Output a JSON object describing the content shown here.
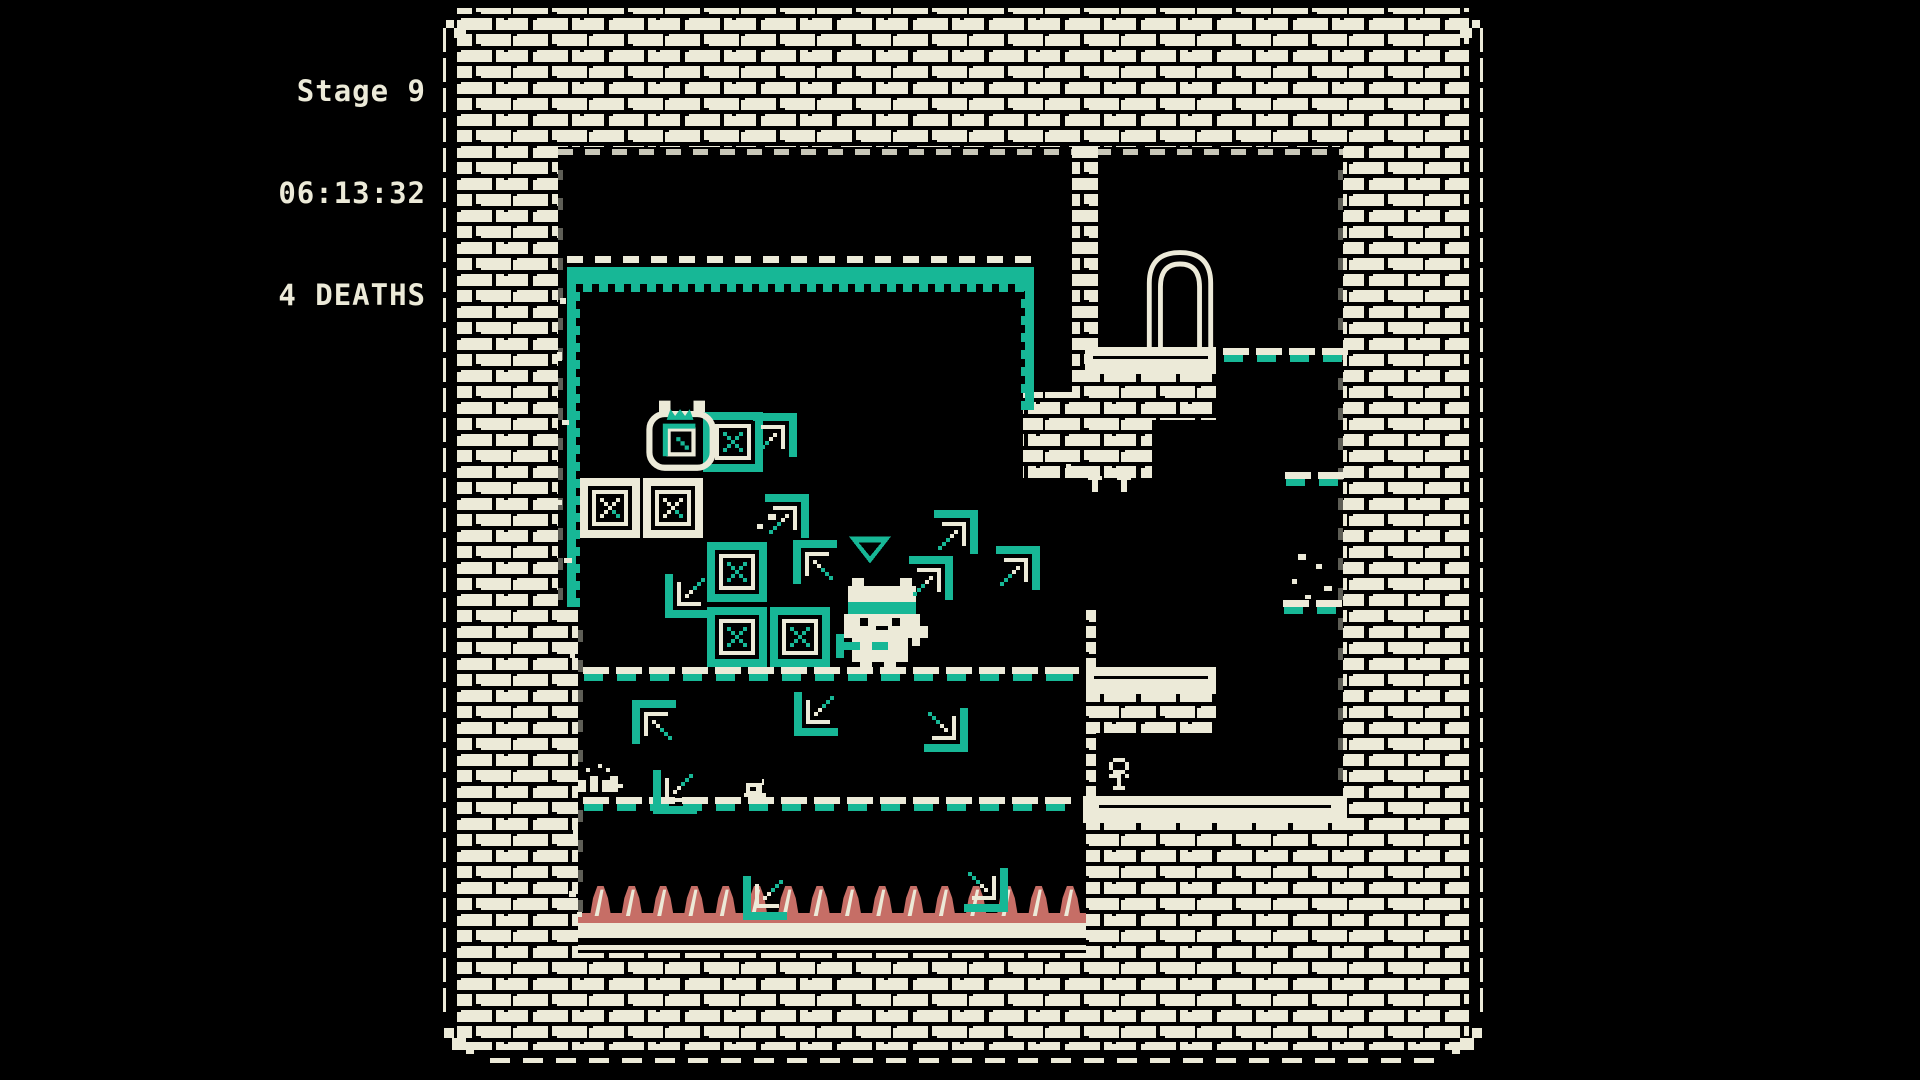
{
  "hud": {
    "stage": "Stage 9",
    "time": "06:13:32",
    "deaths": "4 DEATHS"
  },
  "palette": {
    "cream": "#ECEAD8",
    "teal": "#17B796",
    "rose": "#C66E66",
    "black": "#000000"
  },
  "stage": {
    "frame": {
      "x": 436,
      "y": 0,
      "w": 1054,
      "h": 1080
    },
    "cavities": [
      {
        "x": 558,
        "y": 147,
        "w": 517,
        "h": 460
      },
      {
        "x": 1075,
        "y": 478,
        "w": 21,
        "h": 129
      },
      {
        "x": 578,
        "y": 607,
        "w": 508,
        "h": 346
      },
      {
        "x": 1096,
        "y": 147,
        "w": 247,
        "h": 676
      }
    ],
    "brick_patches": [
      {
        "x": 1072,
        "y": 147,
        "w": 26,
        "h": 247
      },
      {
        "x": 1023,
        "y": 392,
        "w": 129,
        "h": 86
      },
      {
        "x": 1085,
        "y": 373,
        "w": 131,
        "h": 47
      },
      {
        "x": 1090,
        "y": 694,
        "w": 126,
        "h": 39
      }
    ],
    "ledges": [
      {
        "x": 1085,
        "y": 347,
        "w": 131,
        "h": 27
      },
      {
        "x": 1086,
        "y": 667,
        "w": 130,
        "h": 27
      },
      {
        "x": 1083,
        "y": 796,
        "w": 264,
        "h": 27
      }
    ],
    "arch": {
      "x": 1140,
      "y": 243,
      "w": 80,
      "h": 105
    },
    "zone": {
      "top": {
        "x": 567,
        "y": 256,
        "w": 467,
        "h": 36
      },
      "left": {
        "x": 567,
        "y": 272,
        "w": 13,
        "h": 335
      },
      "right": {
        "x": 1021,
        "y": 272,
        "w": 13,
        "h": 138
      }
    },
    "edge_rows": [
      {
        "x": 558,
        "y": 149,
        "w": 517
      },
      {
        "x": 1096,
        "y": 149,
        "w": 247
      }
    ],
    "edge_cols": [
      {
        "x": 558,
        "y": 170,
        "h": 430
      },
      {
        "x": 578,
        "y": 612,
        "h": 300
      },
      {
        "x": 1338,
        "y": 170,
        "h": 640
      }
    ],
    "dash_rows": [
      {
        "x": 583,
        "y": 667,
        "count": 15
      },
      {
        "x": 1053,
        "y": 667,
        "count": 1
      },
      {
        "x": 583,
        "y": 797,
        "count": 15
      },
      {
        "x": 1223,
        "y": 348,
        "count": 4
      },
      {
        "x": 1285,
        "y": 472,
        "count": 2
      },
      {
        "x": 1283,
        "y": 600,
        "count": 2
      }
    ],
    "spikes": {
      "x": 585,
      "y": 886,
      "count": 16,
      "pitch": 31.3
    },
    "pit": {
      "x": 578,
      "y": 913,
      "w": 508,
      "h": 40
    }
  },
  "sprites": [
    {
      "type": "crate-teal",
      "x": 703,
      "y": 412
    },
    {
      "type": "crate-cream",
      "x": 580,
      "y": 478
    },
    {
      "type": "crate-cream",
      "x": 643,
      "y": 478
    },
    {
      "type": "crate-teal",
      "x": 707,
      "y": 542
    },
    {
      "type": "crate-teal",
      "x": 707,
      "y": 607
    },
    {
      "type": "crate-teal",
      "x": 770,
      "y": 607
    },
    {
      "type": "ghost-cat",
      "x": 636,
      "y": 396
    },
    {
      "type": "marker",
      "x": 849,
      "y": 536
    },
    {
      "type": "cat",
      "x": 836,
      "y": 578
    },
    {
      "type": "bracket",
      "x": 749,
      "y": 413,
      "rot": 0
    },
    {
      "type": "bracket",
      "x": 761,
      "y": 494,
      "rot": 0
    },
    {
      "type": "bracket",
      "x": 930,
      "y": 510,
      "rot": 0
    },
    {
      "type": "bracket",
      "x": 905,
      "y": 556,
      "rot": 0
    },
    {
      "type": "bracket",
      "x": 992,
      "y": 546,
      "rot": 0
    },
    {
      "type": "bracket",
      "x": 793,
      "y": 540,
      "rot": 270
    },
    {
      "type": "bracket",
      "x": 665,
      "y": 570,
      "rot": 180
    },
    {
      "type": "bracket",
      "x": 632,
      "y": 700,
      "rot": 270
    },
    {
      "type": "bracket",
      "x": 794,
      "y": 688,
      "rot": 180
    },
    {
      "type": "bracket",
      "x": 920,
      "y": 704,
      "rot": 90
    },
    {
      "type": "bracket",
      "x": 653,
      "y": 766,
      "rot": 180
    },
    {
      "type": "bracket",
      "x": 743,
      "y": 872,
      "rot": 180
    },
    {
      "type": "bracket",
      "x": 960,
      "y": 864,
      "rot": 90
    },
    {
      "type": "plant",
      "x": 1101,
      "y": 758
    },
    {
      "type": "shrub",
      "x": 578,
      "y": 764
    },
    {
      "type": "snail",
      "x": 742,
      "y": 779
    },
    {
      "type": "tmark",
      "x": 1088,
      "y": 476
    },
    {
      "type": "tmark",
      "x": 1117,
      "y": 476
    },
    {
      "type": "debris",
      "x": 560,
      "y": 298,
      "w": 6,
      "h": 6
    },
    {
      "type": "debris",
      "x": 557,
      "y": 352,
      "w": 5,
      "h": 9
    },
    {
      "type": "debris",
      "x": 562,
      "y": 420,
      "w": 7,
      "h": 5
    },
    {
      "type": "debris",
      "x": 556,
      "y": 500,
      "w": 6,
      "h": 5
    },
    {
      "type": "debris",
      "x": 564,
      "y": 558,
      "w": 8,
      "h": 5
    },
    {
      "type": "debris",
      "x": 570,
      "y": 650,
      "w": 5,
      "h": 8
    },
    {
      "type": "debris",
      "x": 566,
      "y": 742,
      "w": 6,
      "h": 5
    },
    {
      "type": "debris",
      "x": 573,
      "y": 830,
      "w": 5,
      "h": 5
    },
    {
      "type": "debris",
      "x": 569,
      "y": 891,
      "w": 7,
      "h": 6
    },
    {
      "type": "debris",
      "x": 577,
      "y": 912,
      "w": 5,
      "h": 5
    },
    {
      "type": "debris",
      "x": 768,
      "y": 514,
      "w": 8,
      "h": 6
    },
    {
      "type": "debris",
      "x": 757,
      "y": 524,
      "w": 6,
      "h": 5
    },
    {
      "type": "debris",
      "x": 1052,
      "y": 468,
      "w": 7,
      "h": 5
    },
    {
      "type": "debris",
      "x": 1066,
      "y": 464,
      "w": 5,
      "h": 4
    },
    {
      "type": "debris",
      "x": 1298,
      "y": 554,
      "w": 8,
      "h": 6
    },
    {
      "type": "debris",
      "x": 1316,
      "y": 564,
      "w": 6,
      "h": 5
    },
    {
      "type": "debris",
      "x": 1292,
      "y": 579,
      "w": 5,
      "h": 5
    },
    {
      "type": "debris",
      "x": 1324,
      "y": 586,
      "w": 8,
      "h": 5
    },
    {
      "type": "debris",
      "x": 1305,
      "y": 595,
      "w": 6,
      "h": 4
    },
    {
      "type": "debris",
      "x": 618,
      "y": 784,
      "w": 5,
      "h": 4
    }
  ]
}
